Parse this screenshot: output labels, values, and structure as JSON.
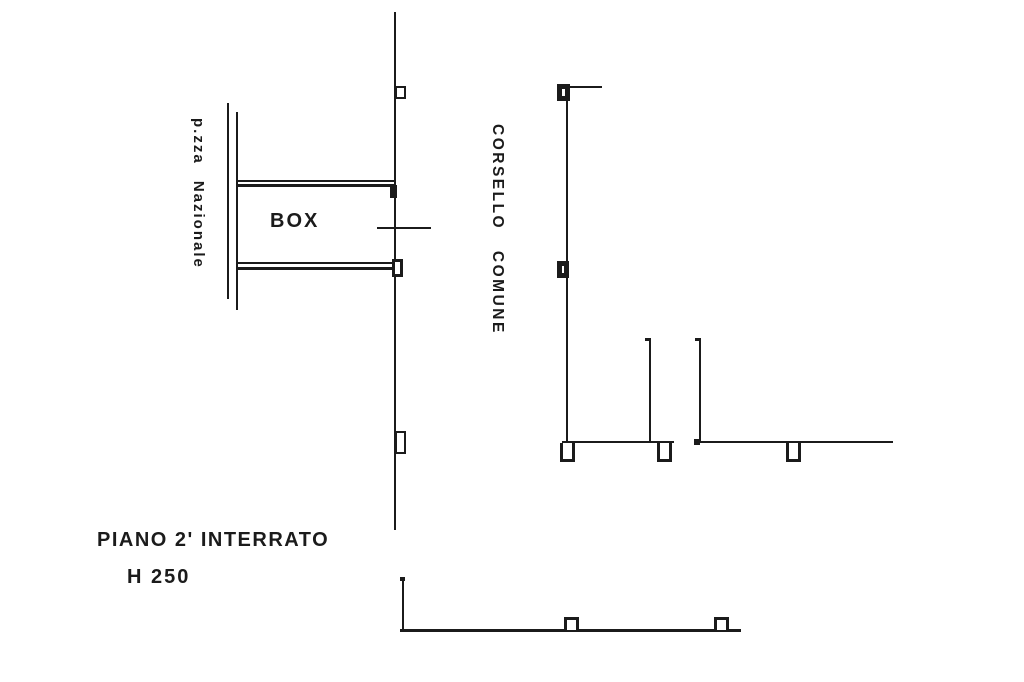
{
  "plan": {
    "floor_title": "PIANO 2' INTERRATO",
    "height_note": "H 250",
    "room_label": "BOX",
    "street_label": "p.zza Nazionale",
    "corridor_label": "CORSELLO COMUNE"
  },
  "colors": {
    "ink": "#1b1b1b",
    "paper": "#ffffff"
  }
}
